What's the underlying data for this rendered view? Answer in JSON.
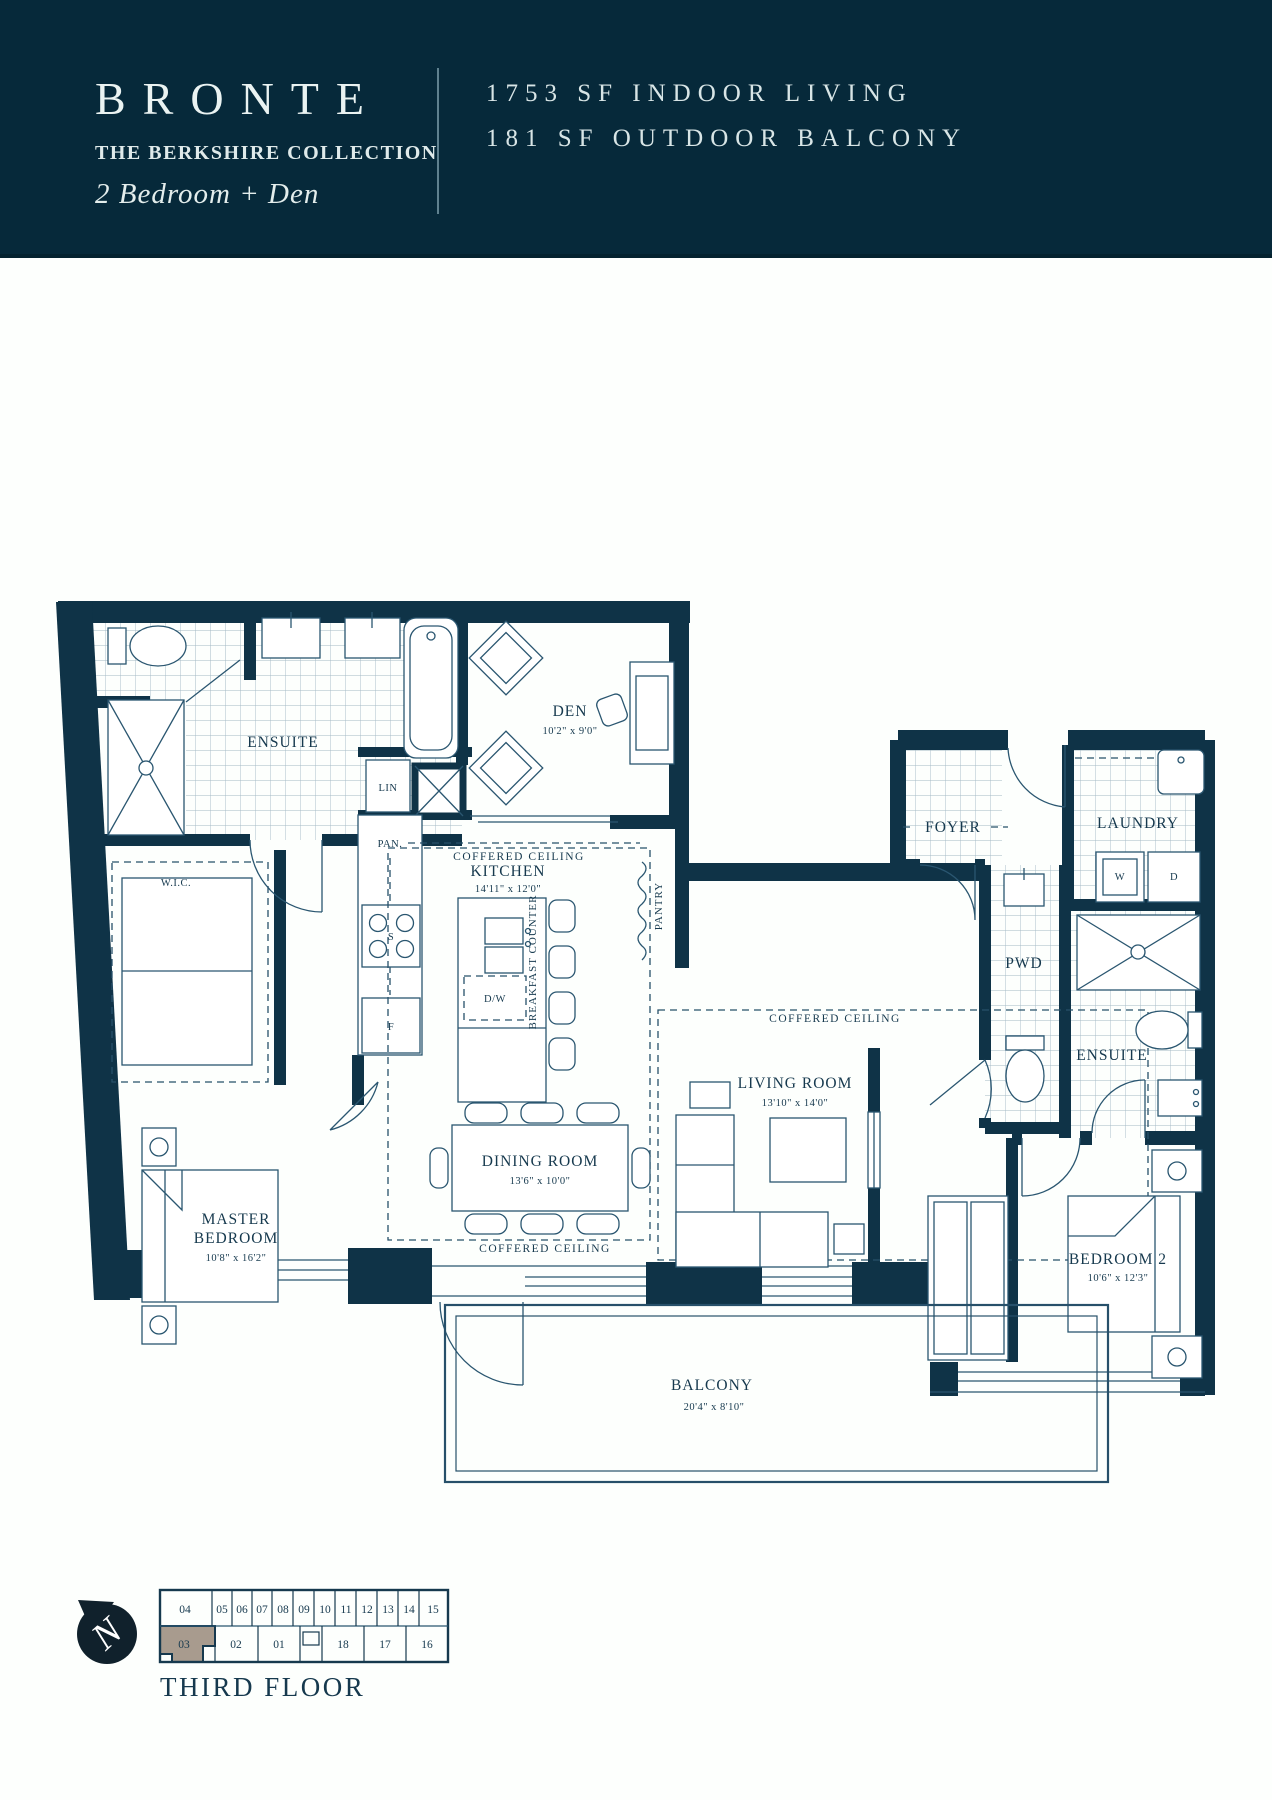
{
  "header": {
    "title": "BRONTE",
    "collection": "THE BERKSHIRE COLLECTION",
    "unit_type": "2 Bedroom + Den",
    "area_line1": "1753 SF INDOOR LIVING",
    "area_line2": "181 SF OUTDOOR BALCONY",
    "banner_color": "#06293a"
  },
  "plan": {
    "wall_color": "#0f3347",
    "rooms": {
      "ensuite_main": {
        "label": "ENSUITE"
      },
      "den": {
        "label": "DEN",
        "dims": "10'2\" x 9'0\""
      },
      "kitchen": {
        "label": "KITCHEN",
        "dims": "14'11\" x 12'0\""
      },
      "wic": {
        "label": "W.I.C."
      },
      "master": {
        "line1": "MASTER",
        "line2": "BEDROOM",
        "dims": "10'8\" x 16'2\""
      },
      "dining": {
        "label": "DINING ROOM",
        "dims": "13'6\" x 10'0\""
      },
      "living": {
        "label": "LIVING ROOM",
        "dims": "13'10\" x 14'0\""
      },
      "foyer": {
        "label": "FOYER"
      },
      "laundry": {
        "label": "LAUNDRY"
      },
      "pwd": {
        "label": "PWD"
      },
      "ensuite2": {
        "label": "ENSUITE"
      },
      "bedroom2": {
        "label": "BEDROOM 2",
        "dims": "10'6\" x 12'3\""
      },
      "balcony": {
        "label": "BALCONY",
        "dims": "20'4\" x 8'10\""
      }
    },
    "annotations": {
      "coffered": "COFFERED CEILING",
      "pan": "PAN.",
      "pantry": "PANTRY",
      "lin": "LIN",
      "breakfast_counter": "BREAKFAST COUNTER",
      "dishwasher": "D/W",
      "stove": "S",
      "fridge": "F",
      "washer": "W",
      "dryer": "D"
    }
  },
  "keyplan": {
    "floor_label": "THIRD FLOOR",
    "north_label": "N",
    "highlighted_unit": "03",
    "highlight_color": "#a89b8e",
    "top_units": [
      "04",
      "05",
      "06",
      "07",
      "08",
      "09",
      "10",
      "11",
      "12",
      "13",
      "14",
      "15"
    ],
    "bottom_units": [
      "03",
      "02",
      "01",
      "18",
      "17",
      "16"
    ]
  }
}
